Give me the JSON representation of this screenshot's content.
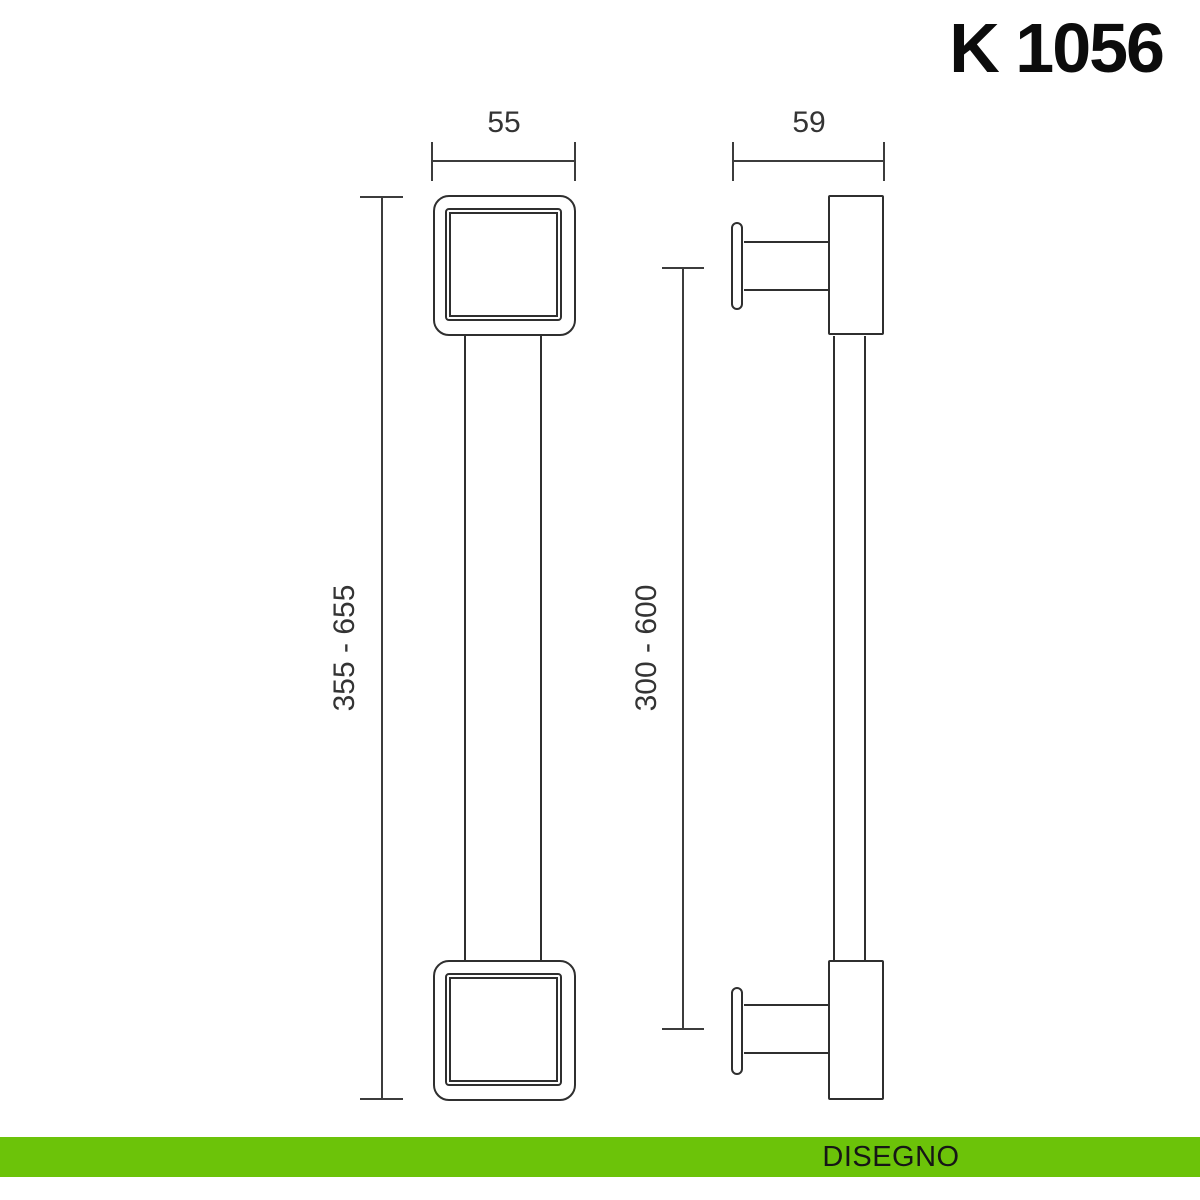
{
  "title": "K 1056",
  "views": {
    "front": {
      "width_dim": "55",
      "height_dim": "355 - 655"
    },
    "side": {
      "depth_dim": "59",
      "centers_dim": "300 - 600"
    }
  },
  "footer": {
    "label": "DISEGNO"
  },
  "colors": {
    "accent_green": "#6cc309",
    "line": "#2f2f2f",
    "background": "#ffffff"
  }
}
